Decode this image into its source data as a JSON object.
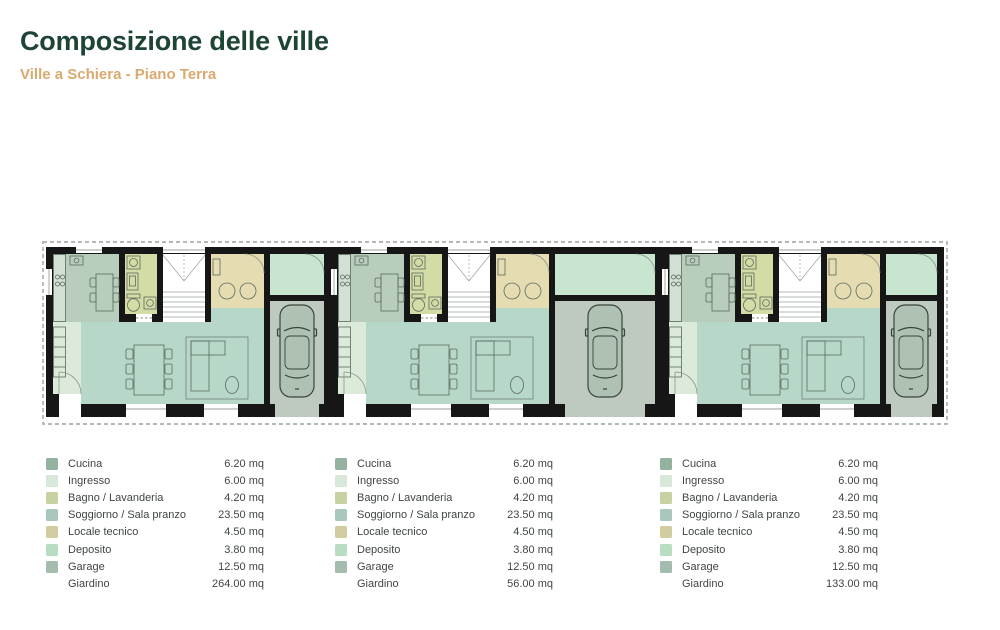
{
  "header": {
    "title": "Composizione delle ville",
    "subtitle": "Ville a Schiera - Piano Terra"
  },
  "colors": {
    "title_text": "#1e4434",
    "subtitle_text": "#d9a96e",
    "legend_text": "#3f4642",
    "wall": "#161616",
    "boundary_dash": "#9aa39c",
    "plan_rooms": {
      "cucina": "#b8cdbb",
      "ingresso": "#dcebd9",
      "bagno": "#d4dca6",
      "soggiorno": "#b7d7c9",
      "locale_tecnico": "#e6dcb2",
      "deposito": "#c8e5cf",
      "garage": "#bec9c0",
      "scala": "#ffffff"
    },
    "car_fill": "#aec1b2",
    "furniture_stroke": "#5a6b60"
  },
  "legends": [
    {
      "unit": "villa-1",
      "rows": [
        {
          "label": "Cucina",
          "value": "6.20 mq",
          "swatch": "#93b29f"
        },
        {
          "label": "Ingresso",
          "value": "6.00 mq",
          "swatch": "#d8e8d8"
        },
        {
          "label": "Bagno / Lavanderia",
          "value": "4.20 mq",
          "swatch": "#c7d2a2"
        },
        {
          "label": "Soggiorno / Sala pranzo",
          "value": "23.50 mq",
          "swatch": "#a9c7bd"
        },
        {
          "label": "Locale tecnico",
          "value": "4.50 mq",
          "swatch": "#d2cda1"
        },
        {
          "label": "Deposito",
          "value": "3.80 mq",
          "swatch": "#b9ddc3"
        },
        {
          "label": "Garage",
          "value": "12.50 mq",
          "swatch": "#a3bcad"
        },
        {
          "label": "Giardino",
          "value": "264.00 mq",
          "swatch": null
        }
      ]
    },
    {
      "unit": "villa-2",
      "rows": [
        {
          "label": "Cucina",
          "value": "6.20 mq",
          "swatch": "#93b29f"
        },
        {
          "label": "Ingresso",
          "value": "6.00 mq",
          "swatch": "#d8e8d8"
        },
        {
          "label": "Bagno / Lavanderia",
          "value": "4.20 mq",
          "swatch": "#c7d2a2"
        },
        {
          "label": "Soggiorno / Sala pranzo",
          "value": "23.50 mq",
          "swatch": "#a9c7bd"
        },
        {
          "label": "Locale tecnico",
          "value": "4.50 mq",
          "swatch": "#d2cda1"
        },
        {
          "label": "Deposito",
          "value": "3.80 mq",
          "swatch": "#b9ddc3"
        },
        {
          "label": "Garage",
          "value": "12.50 mq",
          "swatch": "#a3bcad"
        },
        {
          "label": "Giardino",
          "value": "56.00 mq",
          "swatch": null
        }
      ]
    },
    {
      "unit": "villa-3",
      "rows": [
        {
          "label": "Cucina",
          "value": "6.20 mq",
          "swatch": "#93b29f"
        },
        {
          "label": "Ingresso",
          "value": "6.00 mq",
          "swatch": "#d8e8d8"
        },
        {
          "label": "Bagno / Lavanderia",
          "value": "4.20 mq",
          "swatch": "#c7d2a2"
        },
        {
          "label": "Soggiorno / Sala pranzo",
          "value": "23.50 mq",
          "swatch": "#a9c7bd"
        },
        {
          "label": "Locale tecnico",
          "value": "4.50 mq",
          "swatch": "#d2cda1"
        },
        {
          "label": "Deposito",
          "value": "3.80 mq",
          "swatch": "#b9ddc3"
        },
        {
          "label": "Garage",
          "value": "12.50 mq",
          "swatch": "#a3bcad"
        },
        {
          "label": "Giardino",
          "value": "133.00 mq",
          "swatch": null
        }
      ]
    }
  ]
}
